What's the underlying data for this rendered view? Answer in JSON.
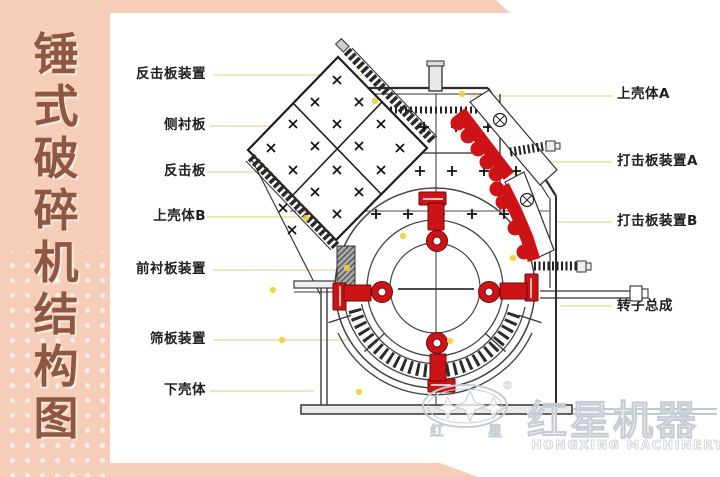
{
  "sidebar": {
    "title": "锤式破碎机结构图",
    "title_chars": [
      "锤",
      "式",
      "破",
      "碎",
      "机",
      "结",
      "构",
      "图"
    ],
    "bg_color": "#f5cdb9",
    "text_color": "#8e5741"
  },
  "diagram": {
    "left_labels": [
      "反击板装置",
      "侧衬板",
      "反击板",
      "上壳体B",
      "前衬板装置",
      "筛板装置",
      "下壳体"
    ],
    "right_labels": [
      "上壳体A",
      "打击板装置A",
      "打击板装置B",
      "转子总成"
    ]
  },
  "watermark": {
    "badge_chars": [
      "红",
      "星"
    ],
    "brand_cn": "红星机器",
    "brand_en": "HONGXING MACHINERY",
    "registered": "®"
  },
  "colors": {
    "hammer_red": "#ce1317",
    "leader_yellow": "#e9dfa6",
    "line_dark": "#3a3a3a",
    "watermark_gray": "#c7cdd5",
    "frame_pink": "#f5cdb9"
  }
}
